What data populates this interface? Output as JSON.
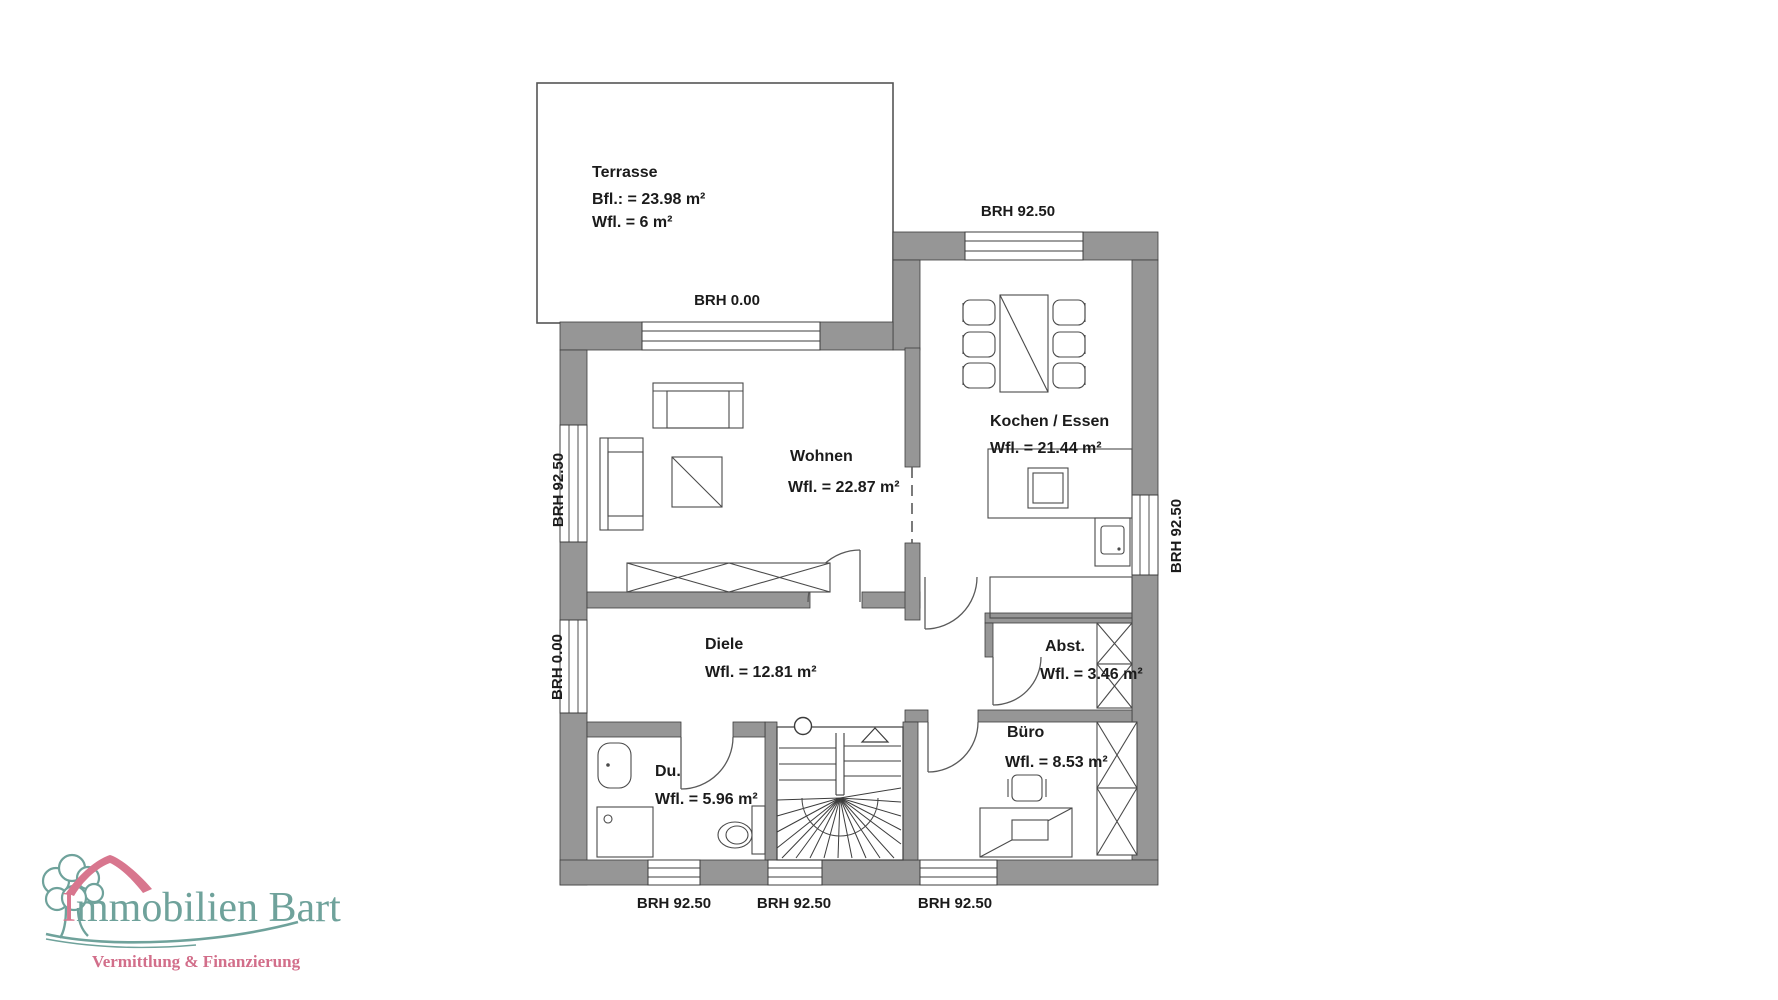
{
  "document": {
    "type": "floor-plan-scan",
    "background": "#ffffff"
  },
  "colors": {
    "wall": "#969696",
    "line": "#3c3c3c",
    "text": "#1b1b1b",
    "logo_teal": "#6fa29b",
    "logo_rose": "#d8768e"
  },
  "rooms": {
    "terrasse": {
      "name": "Terrasse",
      "bfl": "Bfl.: = 23.98 m²",
      "wfl": "Wfl. = 6 m²"
    },
    "wohnen": {
      "name": "Wohnen",
      "wfl": "Wfl. = 22.87 m²"
    },
    "kochen": {
      "name": "Kochen / Essen",
      "wfl": "Wfl. = 21.44 m²"
    },
    "diele": {
      "name": "Diele",
      "wfl": "Wfl. = 12.81 m²"
    },
    "dusche": {
      "name": "Du.",
      "wfl": "Wfl. = 5.96 m²"
    },
    "abstellraum": {
      "name": "Abst.",
      "wfl": "Wfl. = 3.46 m²"
    },
    "buero": {
      "name": "Büro",
      "wfl": "Wfl. = 8.53 m²"
    }
  },
  "sills": {
    "top_kitchen": "BRH 92.50",
    "terrace_door": "BRH 0.00",
    "left_window": "BRH 92.50",
    "left_entry": "BRH 0.00",
    "right_window": "BRH 92.50",
    "bottom_left": "BRH 92.50",
    "bottom_middle": "BRH 92.50",
    "bottom_right": "BRH 92.50"
  },
  "icons": {
    "sofa": "sofa-icon",
    "coffee_table": "coffee-table-icon",
    "sideboard": "sideboard-icon",
    "dining_table": "dining-table-icon",
    "chair": "chair-icon",
    "kitchen_counter": "kitchen-counter-icon",
    "sink": "sink-icon",
    "appliance": "appliance-icon",
    "cupboard": "cupboard-icon",
    "stairs": "stairs-icon",
    "washbasin": "washbasin-icon",
    "shower": "shower-icon",
    "toilet": "toilet-icon",
    "desk": "desk-icon",
    "office_chair": "office-chair-icon",
    "shelf": "shelf-icon"
  },
  "logo": {
    "brand_first_letter": "I",
    "brand_rest": "mmobilien Bart",
    "brand": "Immobilien Bart",
    "tagline": "Vermittlung & Finanzierung"
  }
}
